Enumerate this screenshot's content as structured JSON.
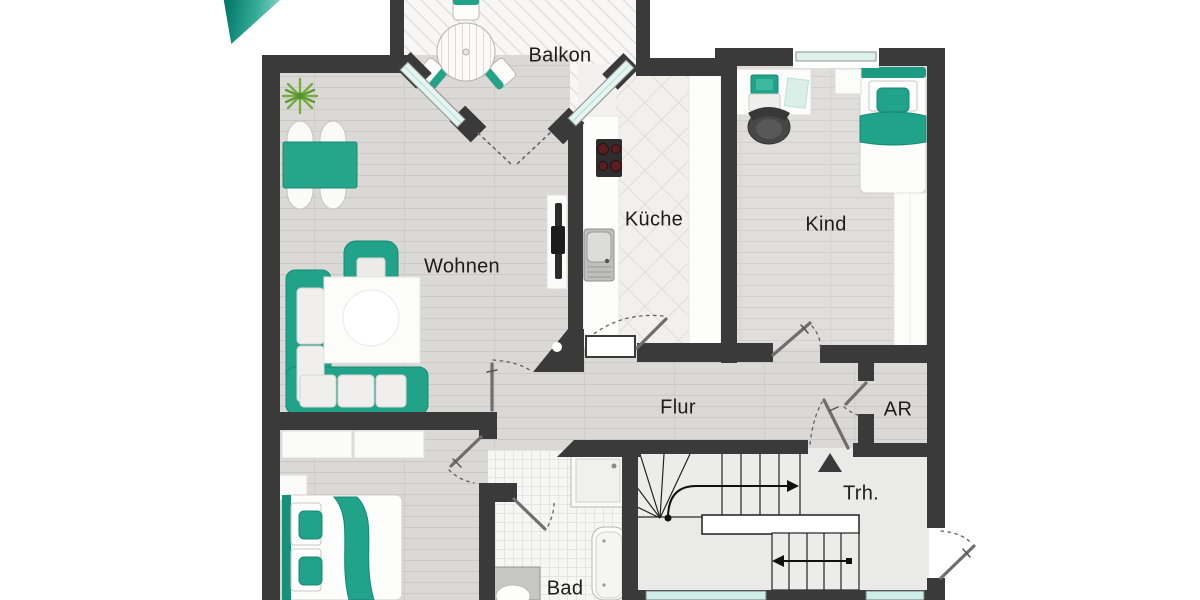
{
  "title": "Grundriss Wohnung (Floor plan)",
  "rooms": [
    {
      "id": "balkon",
      "label": "Balkon"
    },
    {
      "id": "wohnen",
      "label": "Wohnen"
    },
    {
      "id": "kueche",
      "label": "Küche"
    },
    {
      "id": "kind",
      "label": "Kind"
    },
    {
      "id": "flur",
      "label": "Flur"
    },
    {
      "id": "ar",
      "label": "AR"
    },
    {
      "id": "trh",
      "label": "Trh."
    },
    {
      "id": "bad",
      "label": "Bad"
    }
  ],
  "colors": {
    "wall": "#3a3a3a",
    "accent_teal": "#21a38a",
    "window_glass": "#d9f0ec",
    "wood_floor": "#dbd9d6",
    "tile_floor": "#f2f0ec",
    "stair_floor": "#eaeae9"
  }
}
